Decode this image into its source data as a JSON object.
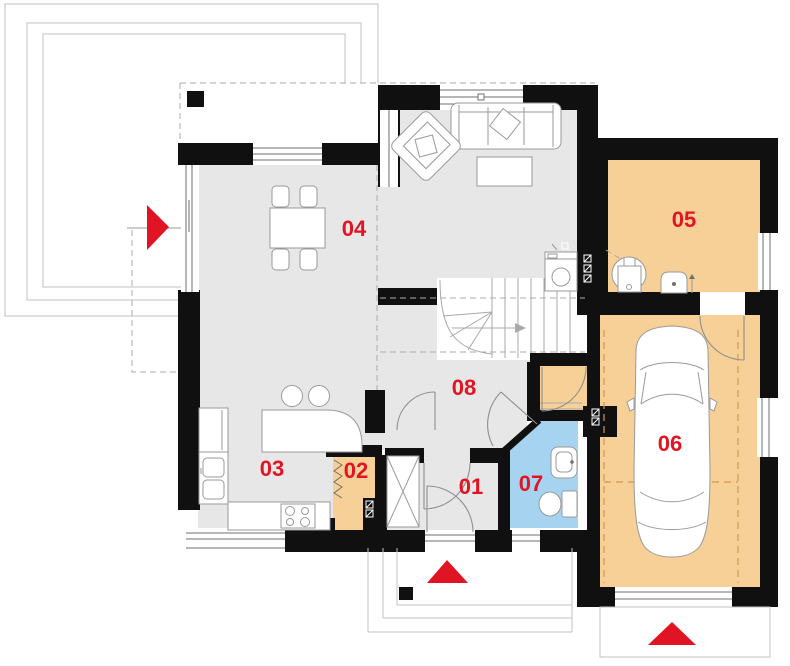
{
  "rooms": [
    {
      "id": "room-01",
      "label": "01"
    },
    {
      "id": "room-02",
      "label": "02"
    },
    {
      "id": "room-03",
      "label": "03"
    },
    {
      "id": "room-04",
      "label": "04"
    },
    {
      "id": "room-05",
      "label": "05"
    },
    {
      "id": "room-06",
      "label": "06"
    },
    {
      "id": "room-07",
      "label": "07"
    },
    {
      "id": "room-08",
      "label": "08"
    }
  ],
  "colors": {
    "wall": "#101010",
    "floor_gray": "#e7e7e7",
    "room_orange": "#f6d096",
    "room_blue": "#a6d4f0",
    "accent_red": "#e11423",
    "outline_gray": "#c2c2c2",
    "garage_dash": "#cf9a55"
  },
  "markers": {
    "terrace_entrance_arrow": "right",
    "main_entrance_arrow": "up",
    "garage_entrance_arrow": "up"
  }
}
